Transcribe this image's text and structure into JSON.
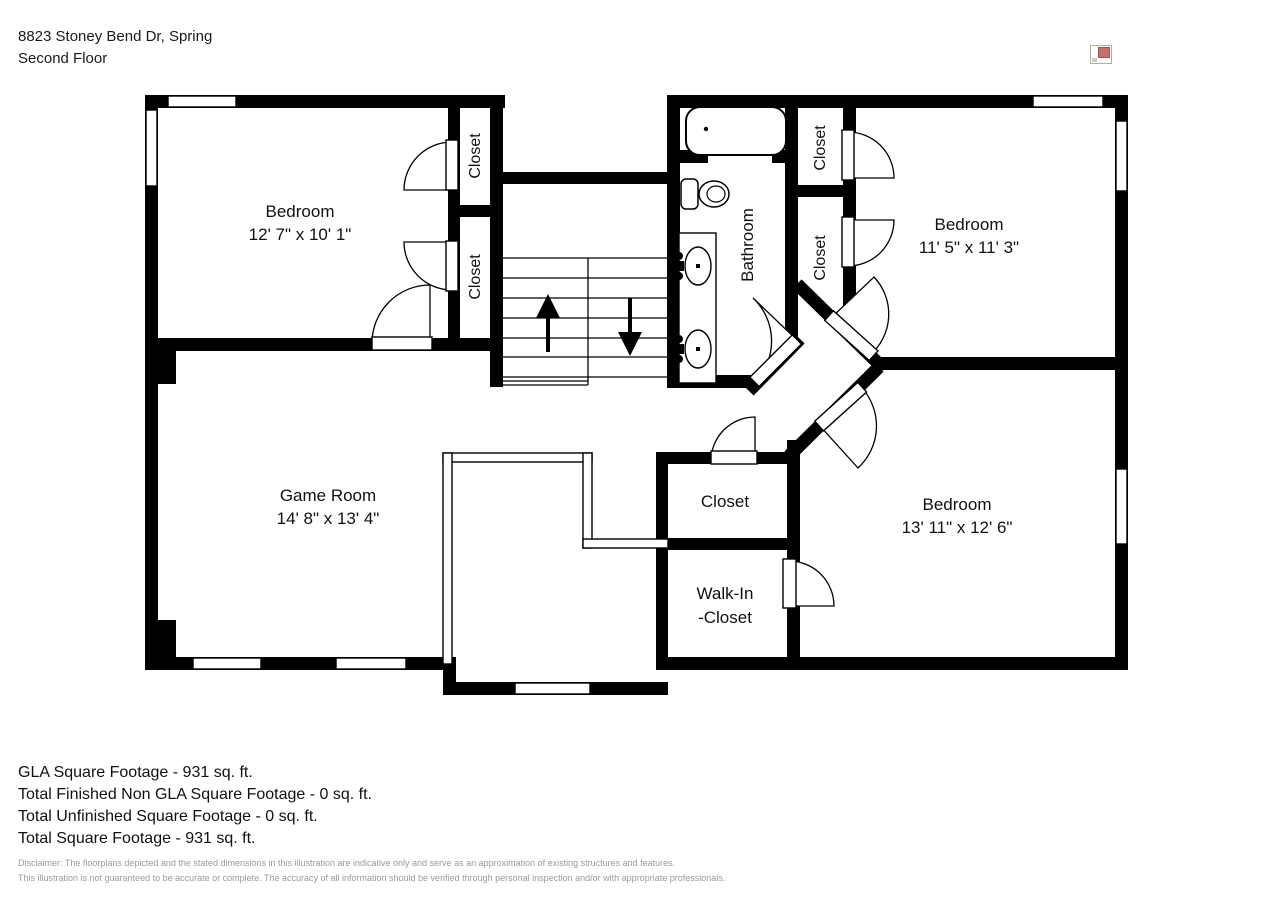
{
  "header": {
    "address": "8823 Stoney Bend Dr, Spring",
    "floor": "Second Floor"
  },
  "floorplan": {
    "rooms": {
      "bedroom_top_left": {
        "name": "Bedroom",
        "dims": "12' 7\" x 10' 1\""
      },
      "bedroom_top_right": {
        "name": "Bedroom",
        "dims": "11' 5\" x 11' 3\""
      },
      "bedroom_bottom_right": {
        "name": "Bedroom",
        "dims": "13' 11\" x 12' 6\""
      },
      "game_room": {
        "name": "Game Room",
        "dims": "14' 8\" x 13' 4\""
      },
      "bathroom": {
        "name": "Bathroom"
      },
      "closet_hall": {
        "name": "Closet"
      },
      "walk_in_closet": {
        "line1": "Walk-In",
        "line2": "-Closet"
      },
      "closet_tl_top": {
        "name": "Closet"
      },
      "closet_tl_bottom": {
        "name": "Closet"
      },
      "closet_tr_top": {
        "name": "Closet"
      },
      "closet_tr_bottom": {
        "name": "Closet"
      }
    }
  },
  "footer": {
    "stats": [
      "GLA Square Footage - 931 sq. ft.",
      "Total Finished Non GLA Square Footage - 0 sq. ft.",
      "Total Unfinished Square Footage - 0 sq. ft.",
      "Total Square Footage - 931 sq. ft."
    ],
    "disclaimer": [
      "Disclaimer: The floorplans depicted and the stated dimensions in this illustration are indicative only and serve as an approximation of existing structures and features.",
      "This illustration is not guaranteed to be accurate or complete. The accuracy of all information should be verified through personal inspection and/or with appropriate professionals."
    ]
  }
}
